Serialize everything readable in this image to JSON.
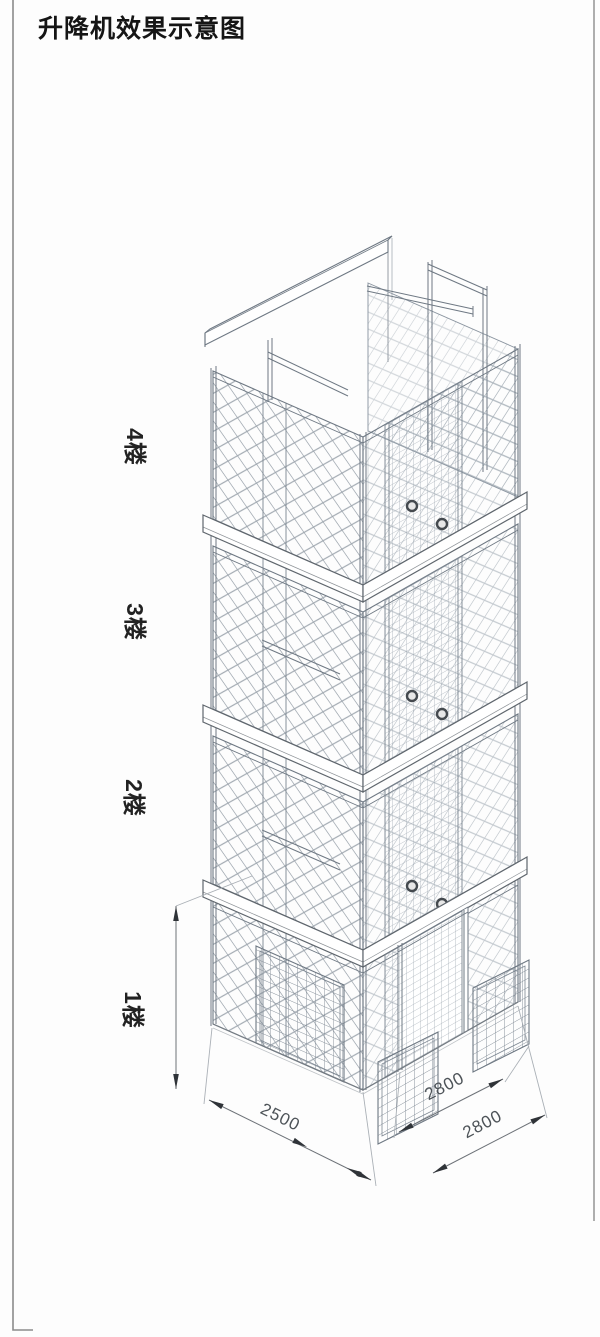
{
  "title": "升降机效果示意图",
  "floors": [
    {
      "label": "4楼"
    },
    {
      "label": "3楼"
    },
    {
      "label": "2楼"
    },
    {
      "label": "1楼"
    }
  ],
  "dimensions": {
    "left_bay_width": "2500",
    "right_bay_width_upper": "2800",
    "right_bay_width_lower": "2800"
  },
  "colors": {
    "line": "#6e7883",
    "mesh": "#8a949e",
    "slab_outline": "#5f666d",
    "dim_line": "#6d7278",
    "dim_text": "#4d5358",
    "text": "#151515",
    "background": "#fdfdfd"
  }
}
